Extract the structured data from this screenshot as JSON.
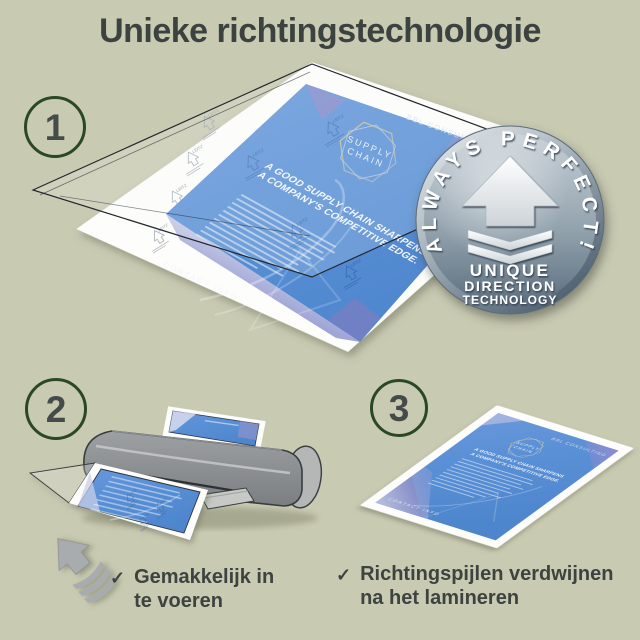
{
  "title": "Unieke richtingstechnologie",
  "colors": {
    "background": "#c9cab2",
    "heading_text": "#3c4240",
    "step_ring_green": "#2b4826",
    "step_number_gray": "#454b49",
    "document_blue": "#5a90d6",
    "badge_steel_blue": "#7c8e9c",
    "laminator_gray": "#8b8f91",
    "arrow_icon_gray": "#a9acae"
  },
  "steps": [
    {
      "number": "1"
    },
    {
      "number": "2"
    },
    {
      "number": "3"
    }
  ],
  "badge": {
    "arc_text": "ALWAYS PERFECT!",
    "line1": "UNIQUE",
    "line2": "DIRECTION",
    "line3": "TECHNOLOGY"
  },
  "document": {
    "brand": "BBL CONSULTING",
    "logo_line1": "SUPPLY",
    "logo_line2": "CHAIN",
    "heading_line1": "A GOOD SUPPLY CHAIN SHARPENS",
    "heading_line2": "A COMPANY'S COMPETITIVE EDGE.",
    "footer": "CONTACT INFO",
    "watermark": "LEITZ"
  },
  "checklist": [
    {
      "check": "✓",
      "line1": "Gemakkelijk in",
      "line2": "te voeren"
    },
    {
      "check": "✓",
      "line1": "Richtingspijlen verdwijnen",
      "line2": "na het lamineren"
    }
  ]
}
